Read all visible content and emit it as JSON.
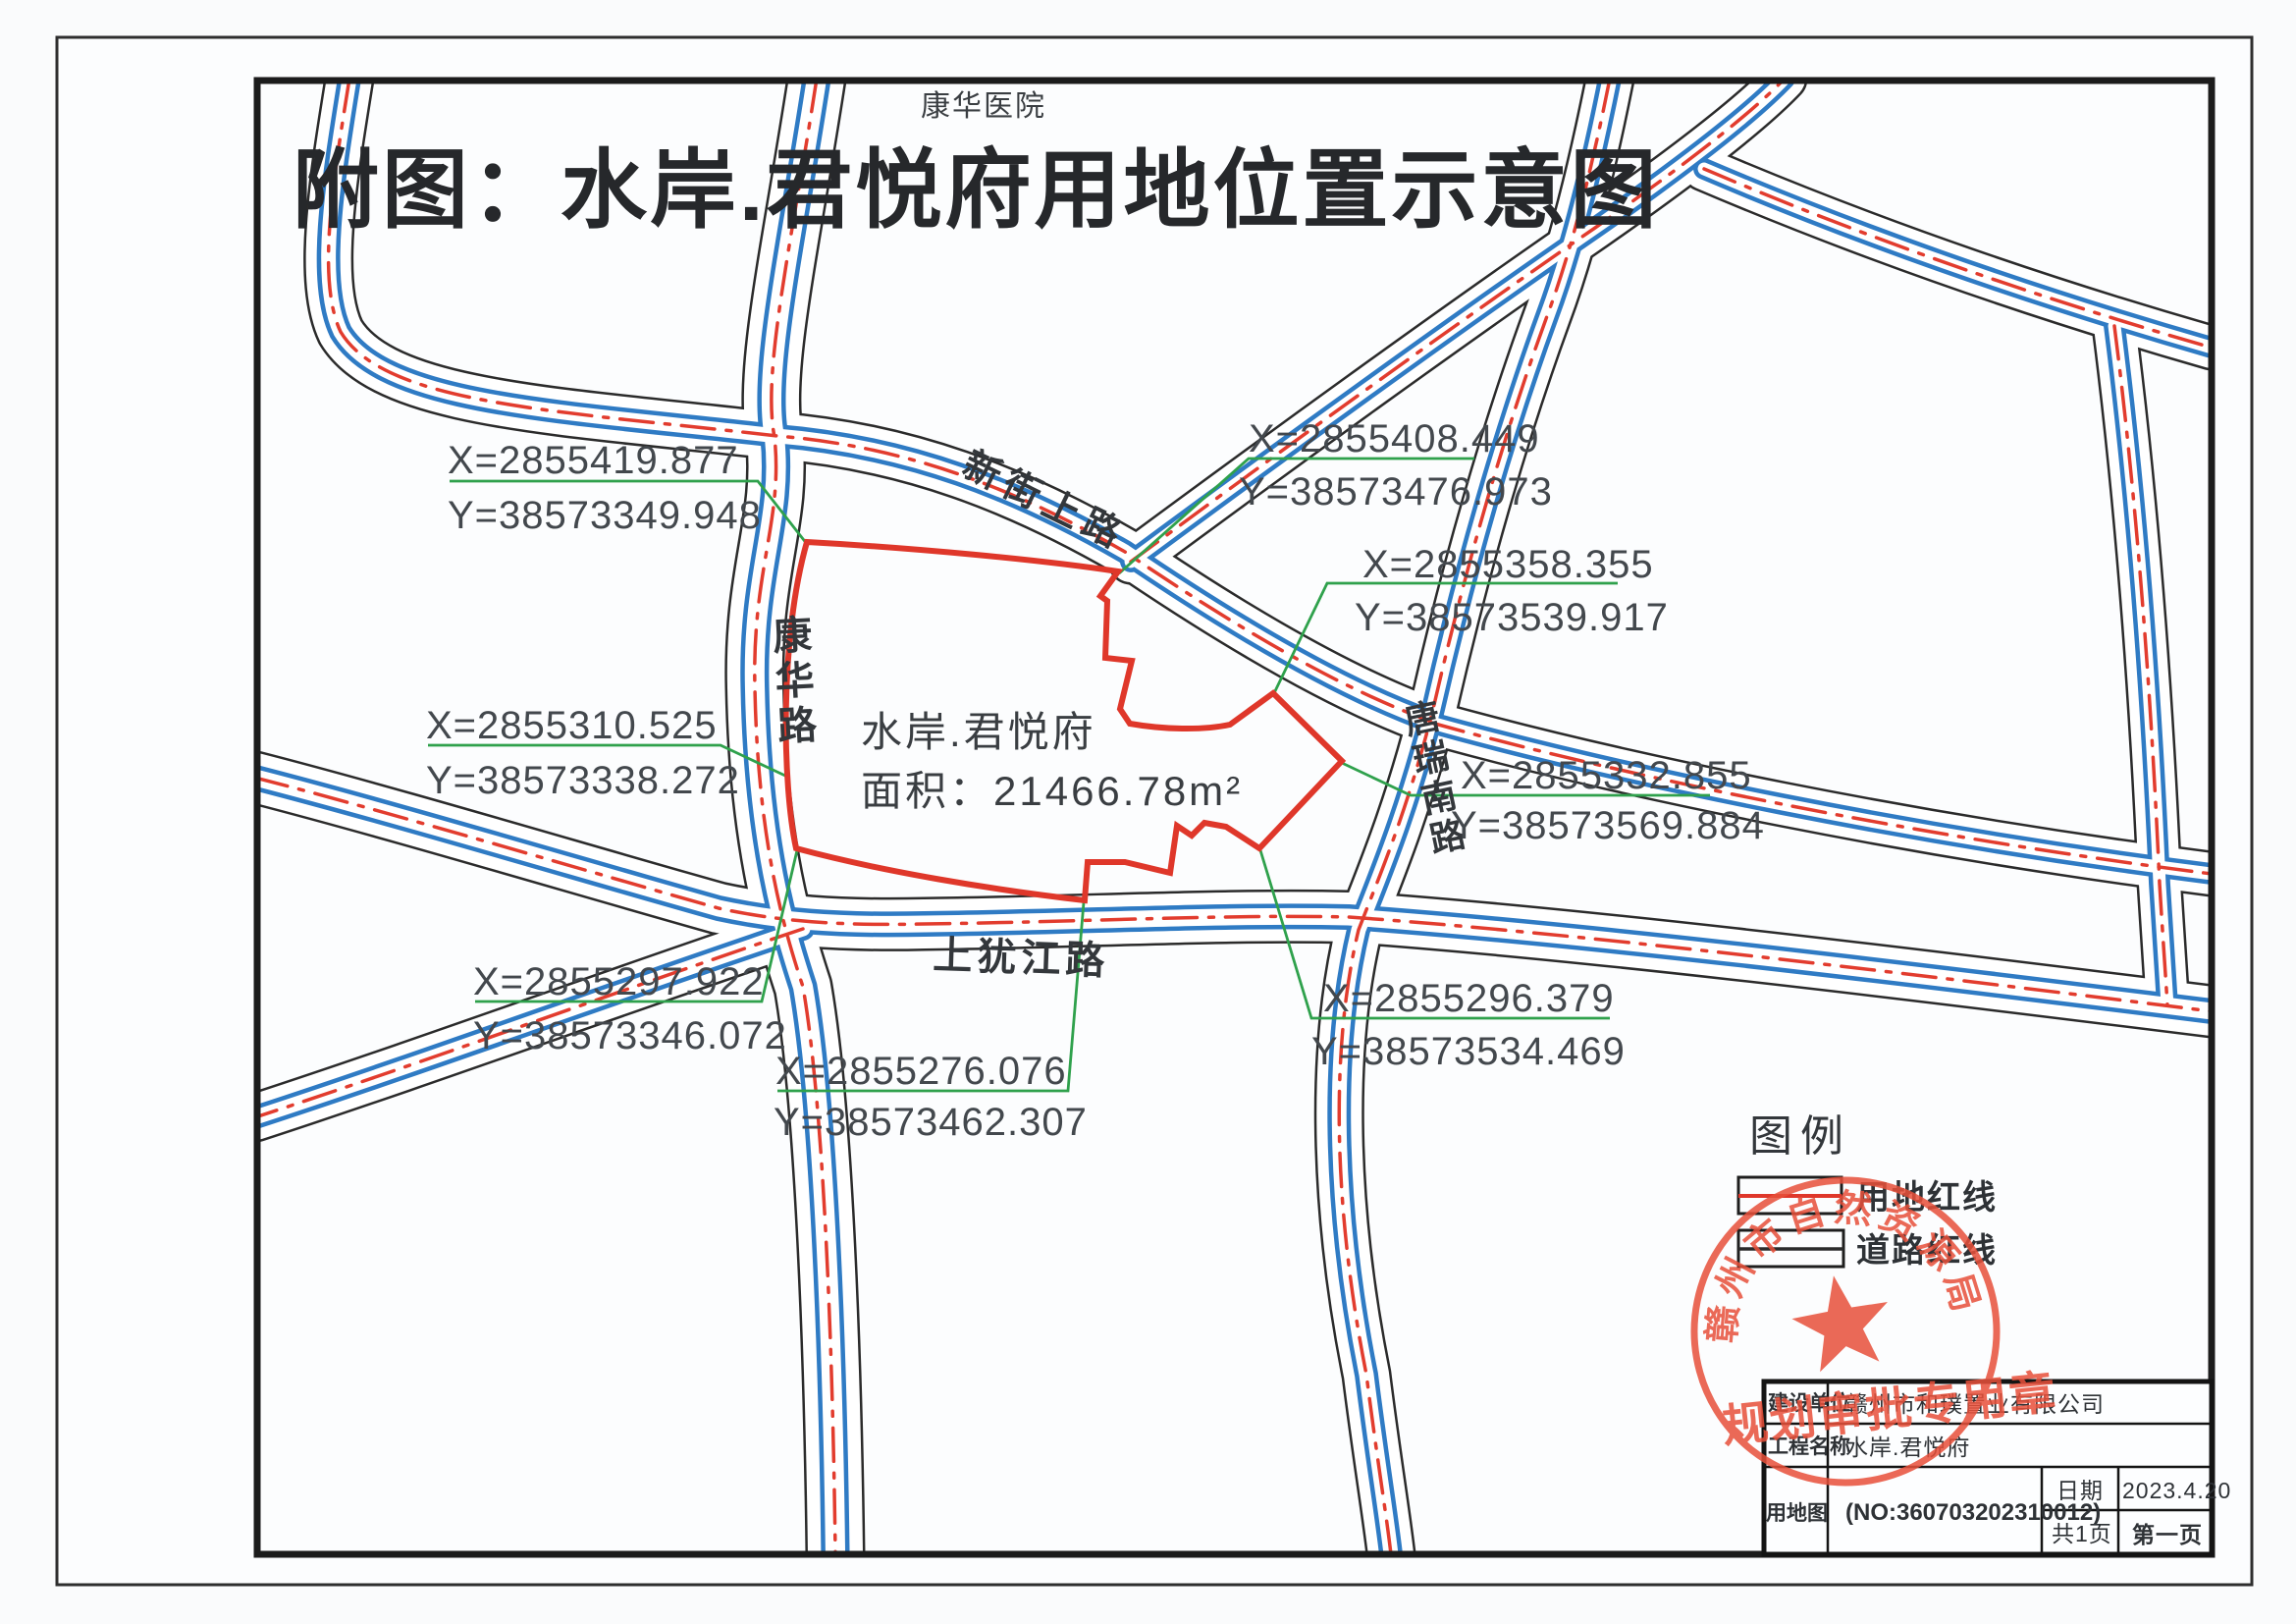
{
  "page": {
    "title": "附图：水岸.君悦府用地位置示意图",
    "hospital_label": "康华医院"
  },
  "parcel": {
    "name": "水岸.君悦府",
    "area_label": "面积：21466.78m²",
    "boundary_color": "#df372a"
  },
  "roads": {
    "kanghua": "康华路",
    "xinjieshang": "新街上路",
    "shangyoujiang": "上犹江路",
    "tangruinan": "唐瑞南路"
  },
  "coordinates": [
    {
      "id": "nw",
      "x_label": "X=2855419.877",
      "y_label": "Y=38573349.948"
    },
    {
      "id": "n",
      "x_label": "X=2855408.449",
      "y_label": "Y=38573476.973"
    },
    {
      "id": "ne",
      "x_label": "X=2855358.355",
      "y_label": "Y=38573539.917"
    },
    {
      "id": "w",
      "x_label": "X=2855310.525",
      "y_label": "Y=38573338.272"
    },
    {
      "id": "e",
      "x_label": "X=2855332.855",
      "y_label": "Y=38573569.884"
    },
    {
      "id": "sw",
      "x_label": "X=2855297.922",
      "y_label": "Y=38573346.072"
    },
    {
      "id": "s",
      "x_label": "X=2855276.076",
      "y_label": "Y=38573462.307"
    },
    {
      "id": "se",
      "x_label": "X=2855296.379",
      "y_label": "Y=38573534.469"
    }
  ],
  "legend": {
    "title": "图例",
    "items": [
      {
        "label": "用地红线",
        "line_color": "#df372a"
      },
      {
        "label": "道路红线",
        "line_color": "#2b2b2b"
      }
    ]
  },
  "stamp": {
    "arc_text": "赣州市自然资源局",
    "line_text": "规划审批专用章",
    "color": "#e8503a"
  },
  "title_block": {
    "rows": [
      {
        "label": "建设单位",
        "value": "赣州市和璞置业有限公司"
      },
      {
        "label": "工程名称",
        "value": "水岸.君悦府"
      }
    ],
    "drawing_label": "用地图",
    "drawing_no": "(NO:360703202310012)",
    "date_label": "日期",
    "date_value": "2023.4.20",
    "pages_label": "共1页",
    "page_value": "第一页"
  },
  "colors": {
    "road_blue": "#2f7bc4",
    "road_red": "#e23c2e",
    "leader_green": "#2fa14c"
  }
}
